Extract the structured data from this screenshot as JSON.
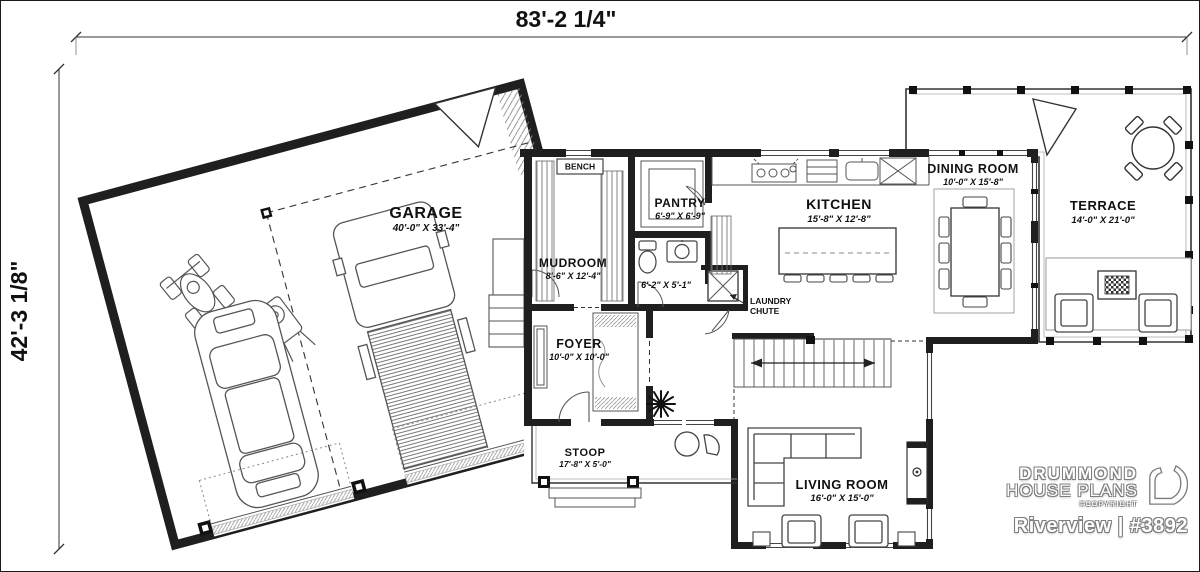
{
  "overall_dimensions": {
    "width": "83'-2 1/4\"",
    "height": "42'-3 1/8\""
  },
  "rooms": [
    {
      "name": "GARAGE",
      "size": "40'-0\" X 33'-4\""
    },
    {
      "name": "MUDROOM",
      "size": "8'-6\" X 12'-4\""
    },
    {
      "name": "PANTRY",
      "size": "6'-9\" X 6'-9\""
    },
    {
      "name": "KITCHEN",
      "size": "15'-8\" X 12'-8\""
    },
    {
      "name": "DINING ROOM",
      "size": "10'-0\" X 15'-8\""
    },
    {
      "name": "TERRACE",
      "size": "14'-0\" X 21'-0\""
    },
    {
      "name": "FOYER",
      "size": "10'-0\" X 10'-0\""
    },
    {
      "name": "STOOP",
      "size": "17'-8\" X 5'-0\""
    },
    {
      "name": "LIVING ROOM",
      "size": "16'-0\" X 15'-0\""
    }
  ],
  "labels": {
    "bench": "BENCH",
    "bath_size": "6'-2\" X 5'-1\"",
    "laundry_line1": "LAUNDRY",
    "laundry_line2": "CHUTE"
  },
  "brand": {
    "line1": "DRUMMOND",
    "line2": "HOUSE PLANS",
    "copyright": "©COPYRIGHT",
    "plan_title": "Riverview | #3892"
  },
  "colors": {
    "ink": "#1a1a1a",
    "thin_line": "#444444",
    "gray": "#999999",
    "logo_outline": "#7d7d7d",
    "logo_fill": "#ffffff"
  }
}
